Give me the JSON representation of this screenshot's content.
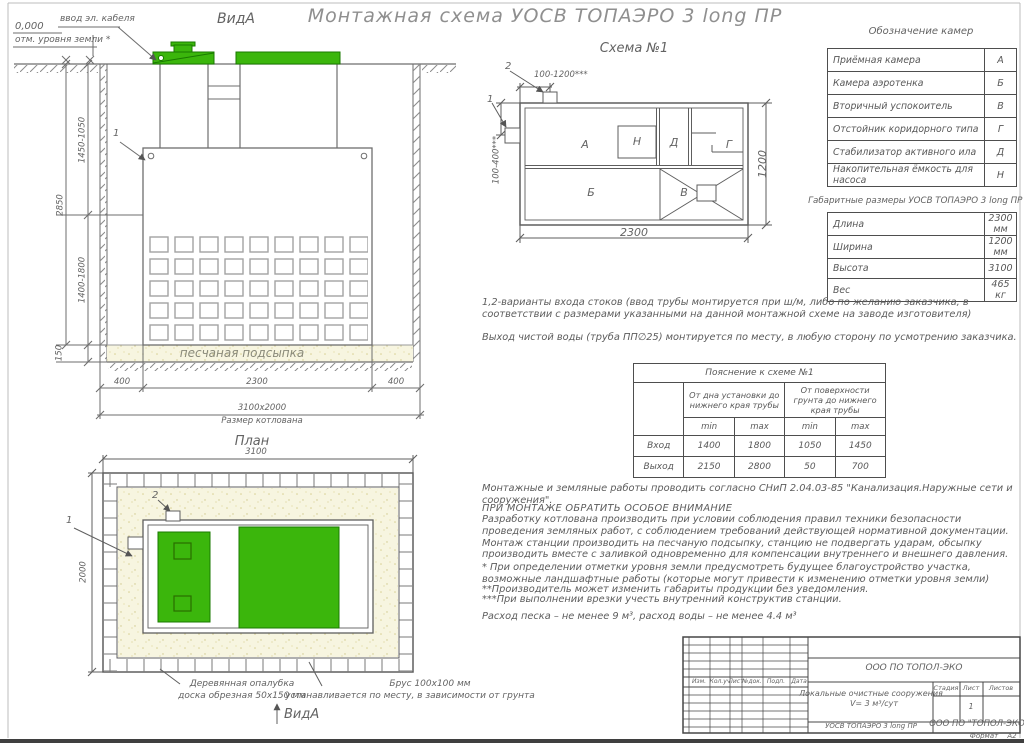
{
  "title": "Монтажная схема УОСВ ТОПАЭРО 3 long ПР",
  "colors": {
    "green": "#3bb60c",
    "green_dark": "#1a7a00",
    "line": "#6e6e6e",
    "text": "#636363",
    "sand": "#f7f5e0"
  },
  "section_view": {
    "label": "ВидА",
    "elevation": "0,000",
    "elevation_note": "отм. уровня земли *",
    "cable_entry": "ввод эл. кабеля",
    "sand_label": "песчаная подсыпка",
    "marker_1": "1",
    "dim_depth_top": "1450-1050",
    "dim_total_depth": "2850",
    "dim_depth_bottom": "1400-1800",
    "dim_sand": "150",
    "dim_left_offset": "400",
    "dim_tank_len": "2300",
    "dim_right_offset": "400",
    "pit_size": "3100х2000",
    "pit_size_label": "Размер котлована"
  },
  "schema": {
    "title": "Схема №1",
    "marker_1": "1",
    "marker_2": "2",
    "dim_inlet_top": "100-1200***",
    "dim_inlet_side": "100-400***",
    "dim_length": "2300",
    "dim_width": "1200",
    "chamber_a": "А",
    "chamber_b": "Б",
    "chamber_v": "В",
    "chamber_g": "Г",
    "chamber_d": "Д",
    "chamber_n": "Н"
  },
  "chambers_table": {
    "title": "Обозначение камер",
    "rows": [
      {
        "name": "Приёмная камера",
        "code": "А"
      },
      {
        "name": "Камера аэротенка",
        "code": "Б"
      },
      {
        "name": "Вторичный успокоитель",
        "code": "В"
      },
      {
        "name": "Отстойник коридорного типа",
        "code": "Г"
      },
      {
        "name": "Стабилизатор активного ила",
        "code": "Д"
      },
      {
        "name": "Накопительная ёмкость для насоса",
        "code": "Н"
      }
    ]
  },
  "dimensions_table": {
    "title": "Габаритные размеры УОСВ ТОПАЭРО 3 long ПР **",
    "rows": [
      {
        "name": "Длина",
        "value": "2300 мм"
      },
      {
        "name": "Ширина",
        "value": "1200 мм"
      },
      {
        "name": "Высота",
        "value": "3100"
      },
      {
        "name": "Вес",
        "value": "465 кг"
      }
    ]
  },
  "notes_top": [
    "1,2-варианты входа  стоков (ввод трубы монтируется при ш/м, либо по желанию заказчика, в соответствии с размерами указанными на данной монтажной схеме на заводе изготовителя)",
    "Выход чистой воды (труба ПП∅25) монтируется по месту, в любую сторону по усмотрению заказчика."
  ],
  "explanation_table": {
    "title": "Пояснение к схеме №1",
    "group1": "От дна установки до нижнего края трубы",
    "group2": "От поверхности грунта до нижнего края трубы",
    "min": "min",
    "max": "max",
    "rows": [
      {
        "name": "Вход",
        "v1": "1400",
        "v2": "1800",
        "v3": "1050",
        "v4": "1450"
      },
      {
        "name": "Выход",
        "v1": "2150",
        "v2": "2800",
        "v3": "50",
        "v4": "700"
      }
    ]
  },
  "notes_bottom": {
    "snip": "Монтажные и земляные работы проводить согласно СНиП 2.04.03-85 \"Канализация.Наружные сети и сооружения\".",
    "attention": "ПРИ МОНТАЖЕ ОБРАТИТЬ ОСОБОЕ ВНИМАНИЕ",
    "paragraph": "Разработку котлована производить при условии соблюдения правил техники безопасности проведения земляных работ, с соблюдением требований действующей нормативной документации. Монтаж станции производить на песчаную подсыпку, станцию не подвергать ударам, обсыпку производить вместе с заливкой одновременно для компенсации внутреннего и внешнего давления.",
    "footnote1": "* При определении отметки уровня земли предусмотреть будущее благоустройство участка, возможные ландшафтные работы (которые могут привести к изменению отметки уровня земли)",
    "footnote2": "**Производитель может изменить габариты продукции без уведомления.",
    "footnote3": "***При выполнении врезки учесть внутренний конструктив станции.",
    "consumption": "Расход песка – не менее 9 м³, расход воды – не менее 4.4 м³"
  },
  "plan_view": {
    "label": "План",
    "dim_width": "3100",
    "dim_height": "2000",
    "marker_1": "1",
    "marker_2": "2",
    "formwork_label_1": "Деревянная опалубка",
    "formwork_label_2": "доска обрезная 50х150 мм",
    "beam_label_1": "Брус 100х100 мм",
    "beam_label_2": "устанавливается по месту, в зависимости от грунта",
    "view_arrow_label": "ВидА"
  },
  "title_block": {
    "company": "ООО ПО ТОПОЛ-ЭКО",
    "columns": [
      "Изм.",
      "Кол.уч",
      "Лист",
      "№док.",
      "Подп.",
      "Дата"
    ],
    "project_line1": "Локальные очистные сооружения",
    "project_line2": "V= 3 м³/сут",
    "stage_label": "Стадия",
    "sheet_label": "Лист",
    "sheets_label": "Листов",
    "sheet_number": "1",
    "product": "УОСВ ТОПАЭРО 3 long ПР",
    "company_short": "ООО ПО \"ТОПОЛ-ЭКО",
    "format_label": "Формат",
    "format_value": "А2"
  }
}
